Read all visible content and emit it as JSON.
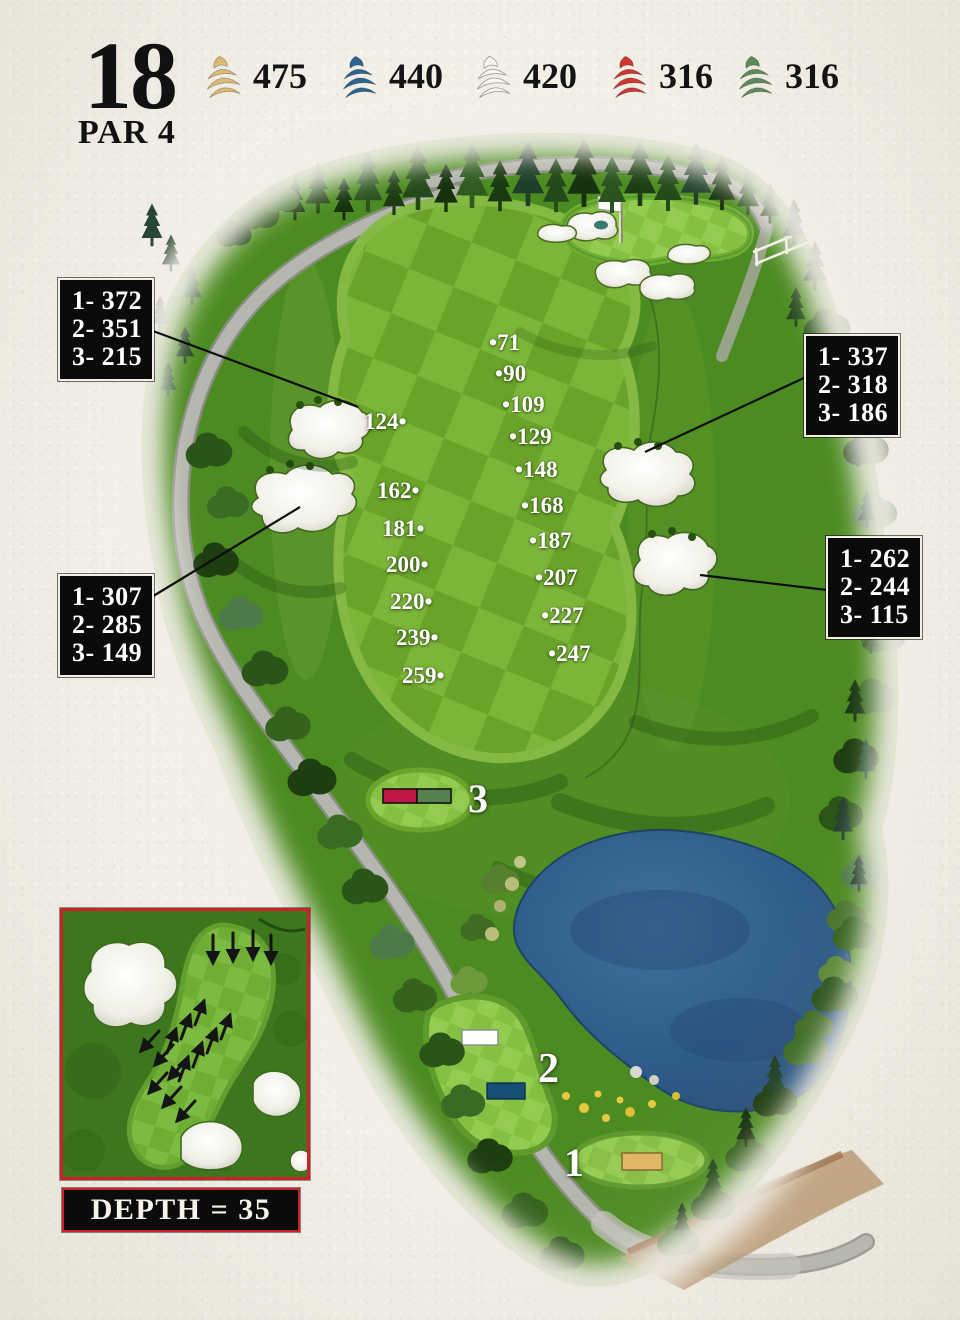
{
  "header": {
    "hole_number": "18",
    "par_label": "PAR 4"
  },
  "tee_legend": [
    {
      "tee": "gold",
      "color": "#dcba74",
      "yardage": "475"
    },
    {
      "tee": "blue",
      "color": "#2b6391",
      "yardage": "440"
    },
    {
      "tee": "white",
      "color": "#f7f7f2",
      "yardage": "420"
    },
    {
      "tee": "red",
      "color": "#cf3732",
      "yardage": "316"
    },
    {
      "tee": "green",
      "color": "#5c8c5a",
      "yardage": "316"
    }
  ],
  "callouts": [
    {
      "position": "upper-left",
      "lines": [
        "1- 372",
        "2- 351",
        "3- 215"
      ]
    },
    {
      "position": "upper-right",
      "lines": [
        "1- 337",
        "2- 318",
        "3- 186"
      ]
    },
    {
      "position": "lower-right",
      "lines": [
        "1- 262",
        "2- 244",
        "3- 115"
      ]
    },
    {
      "position": "lower-left",
      "lines": [
        "1- 307",
        "2- 285",
        "3- 149"
      ]
    }
  ],
  "fairway_yardages": {
    "left_column": [
      "124",
      "162",
      "181",
      "200",
      "220",
      "239",
      "259"
    ],
    "right_column": [
      "71",
      "90",
      "109",
      "129",
      "148",
      "168",
      "187",
      "207",
      "227",
      "247"
    ]
  },
  "tee_boxes": [
    {
      "label": "3",
      "marker_colors": [
        "#c11648",
        "#57804f"
      ]
    },
    {
      "label": "2",
      "marker_colors": [
        "#ffffff",
        "#174e74"
      ]
    },
    {
      "label": "1",
      "marker_colors": [
        "#e2b765"
      ]
    }
  ],
  "green_inset": {
    "depth_label": "DEPTH = 35"
  },
  "palette": {
    "accent_red": "#cc2127",
    "pond_blue": "#2f5c8e",
    "fairway_light": "#7eb83a",
    "fairway_dark": "#6aa42a",
    "bunker_white": "#f6f6ef",
    "paper": "#f2efe7"
  }
}
